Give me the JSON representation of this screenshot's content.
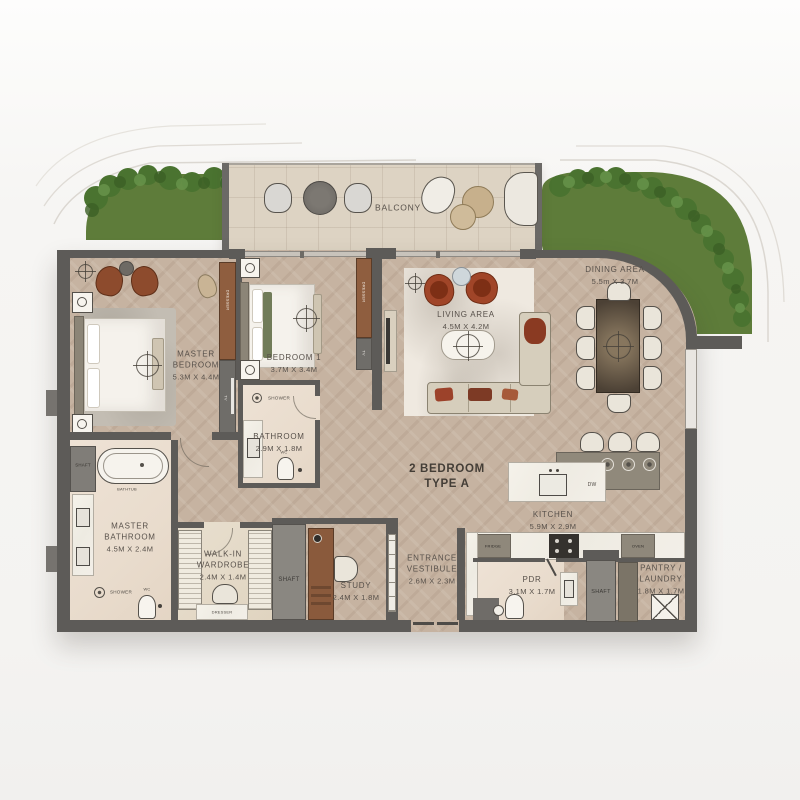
{
  "title": {
    "line1": "2 BEDROOM",
    "line2": "TYPE A"
  },
  "rooms": {
    "balcony": {
      "name": "BALCONY"
    },
    "master_bedroom": {
      "name": "MASTER BEDROOM",
      "dims": "5.3M X 4.4M"
    },
    "bedroom_1": {
      "name": "BEDROOM 1",
      "dims": "3.7M X 3.4M"
    },
    "living_area": {
      "name": "LIVING AREA",
      "dims": "4.5M X 4.2M"
    },
    "dining_area": {
      "name": "DINING AREA",
      "dims": "5.5m X 3.7M"
    },
    "kitchen": {
      "name": "KITCHEN",
      "dims": "5.9M X 2.9M"
    },
    "master_bathroom": {
      "name": "MASTER BATHROOM",
      "dims": "4.5M X 2.4M"
    },
    "bathroom": {
      "name": "BATHROOM",
      "dims": "2.9M X 1.8M"
    },
    "walk_in_wardrobe": {
      "name": "WALK-IN WARDROBE",
      "dims": "2.4M X 1.4M"
    },
    "study": {
      "name": "STUDY",
      "dims": "2.4M X 1.8M"
    },
    "entrance_vestibule": {
      "name": "ENTRANCE VESTIBULE",
      "dims": "2.6M X 2.3M"
    },
    "pdr": {
      "name": "PDR",
      "dims": "3.1M X 1.7M"
    },
    "pantry_laundry": {
      "name": "PANTRY / LAUNDRY",
      "dims": "1.8M X 1.7M"
    },
    "shaft": {
      "name": "SHAFT"
    }
  },
  "fixtures": {
    "bathtub": "BATHTUB",
    "shower": "SHOWER",
    "wc": "WC",
    "dresser": "DRESSER",
    "tv": "TV",
    "fridge": "FRIDGE",
    "oven": "OVEN",
    "dishwasher": "DW"
  },
  "colors": {
    "grass": "#5e7c3a",
    "wall": "#5d5b58",
    "wood_floor": "#c6b3a1",
    "bath_floor": "#ebdfd2",
    "marble": "#f2eee6",
    "balcony_floor": "#ddd3c3",
    "accent_rust": "#9c4227"
  }
}
